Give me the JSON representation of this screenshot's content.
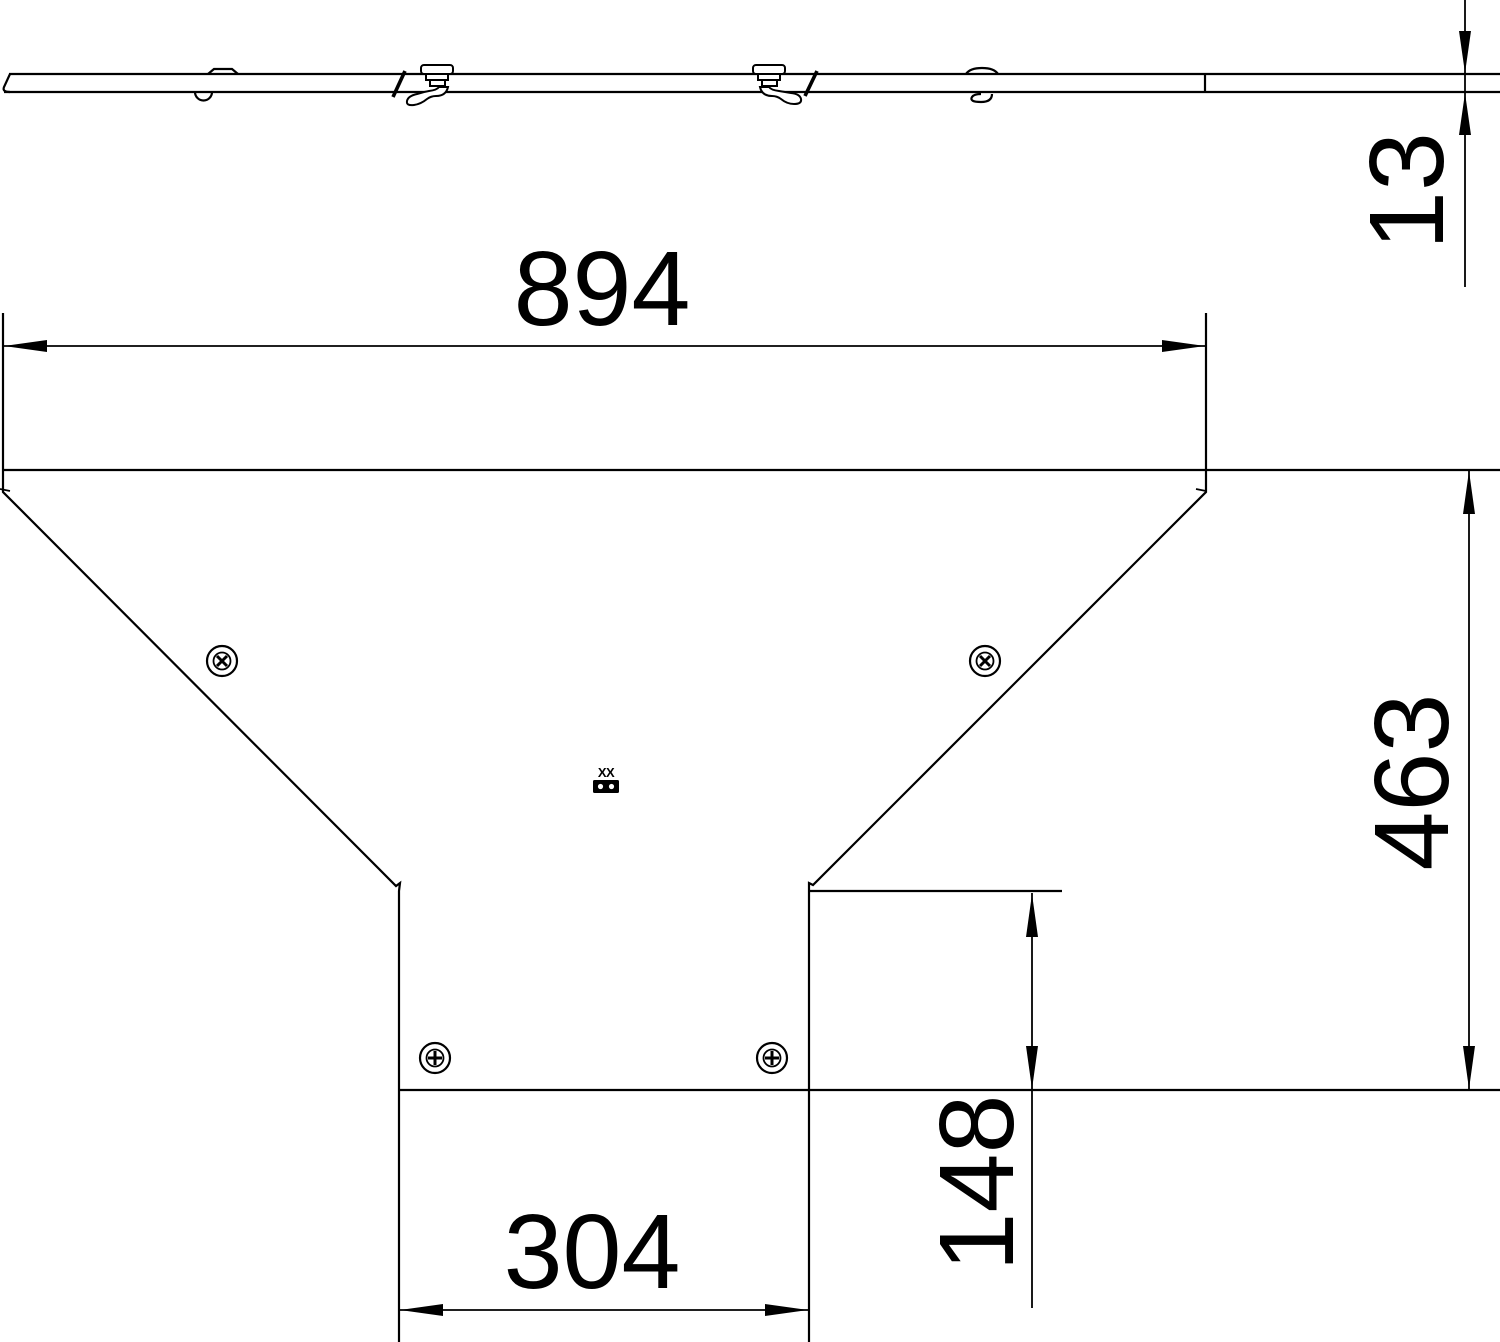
{
  "drawing": {
    "kind": "technical-dimension-drawing",
    "side_view": {
      "thickness_dim_value": "13"
    },
    "plan_view": {
      "width_dim_value": "894",
      "height_dim_value": "463",
      "offset_dim_value": "148",
      "branch_width_dim_value": "304",
      "type_label": "XX"
    },
    "colors": {
      "line": "#000000",
      "background": "#ffffff"
    },
    "icons": [
      "screw-icon",
      "turnbuckle-fastener-icon",
      "dim-arrow-icon",
      "clip-tab-icon"
    ]
  }
}
